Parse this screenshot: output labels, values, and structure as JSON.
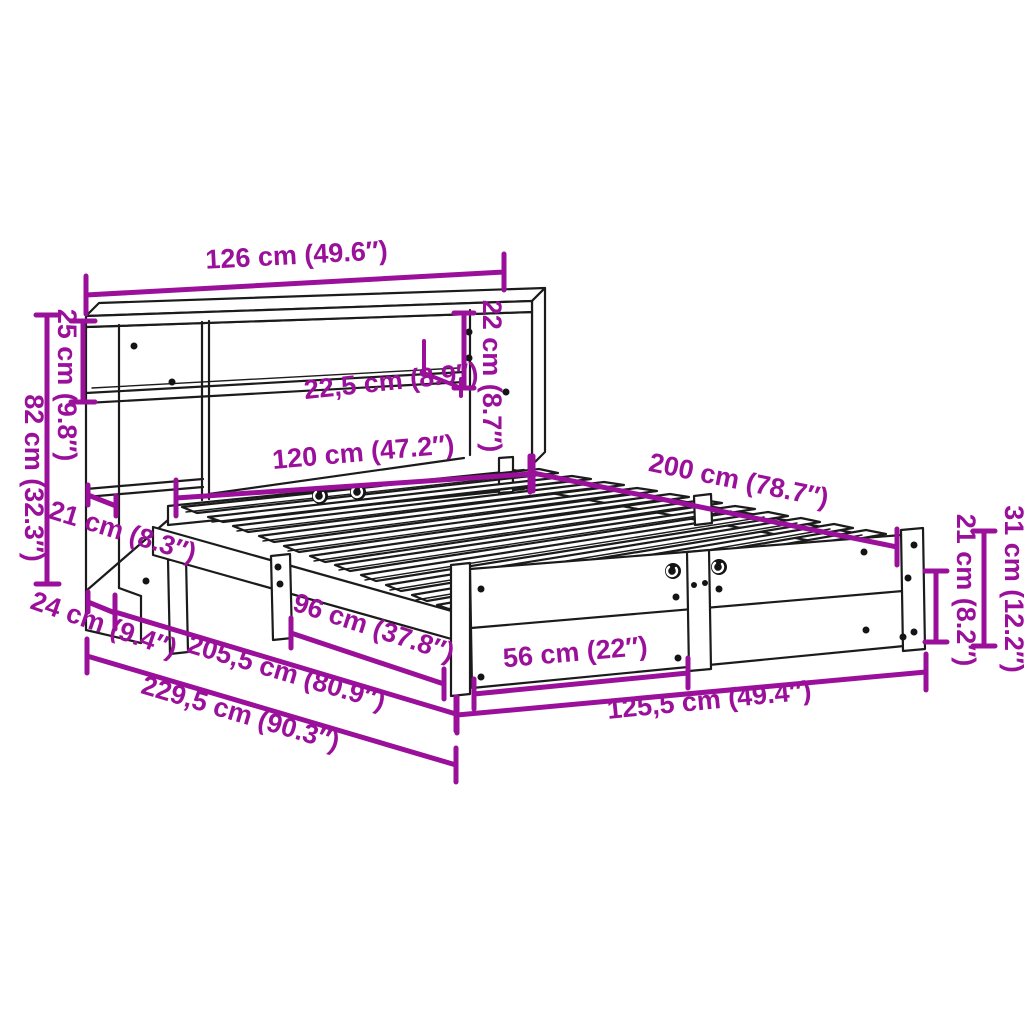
{
  "diagram": {
    "type": "product-dimension-diagram",
    "subject": "bookcase-bed-with-headboard-shelf",
    "background": "#ffffff",
    "accent_color": "#9a109a",
    "line_color": "#1b1b1b",
    "dimensions": [
      {
        "id": "headboard-width",
        "label": "126 cm (49.6″)"
      },
      {
        "id": "headboard-shelf-height",
        "label": "25 cm (9.8″)"
      },
      {
        "id": "headboard-height",
        "label": "82 cm (32.3″)"
      },
      {
        "id": "shelf-depth",
        "label": "22,5 cm (8.9″)"
      },
      {
        "id": "shelf-opening-height",
        "label": "22 cm (8.7″)"
      },
      {
        "id": "inner-width",
        "label": "120 cm (47.2″)"
      },
      {
        "id": "bed-length",
        "label": "200 cm (78.7″)"
      },
      {
        "id": "side-shelf-depth",
        "label": "21 cm (8.3″)"
      },
      {
        "id": "headboard-base-depth",
        "label": "24 cm (9.4″)"
      },
      {
        "id": "side-rail-span",
        "label": "96 cm (37.8″)"
      },
      {
        "id": "total-length",
        "label": "205,5 cm (80.9″)"
      },
      {
        "id": "overall-length",
        "label": "229,5 cm (90.3″)"
      },
      {
        "id": "footboard-section-width",
        "label": "56 cm (22″)"
      },
      {
        "id": "frame-width",
        "label": "125,5 cm (49.4″)"
      },
      {
        "id": "foot-rail-height",
        "label": "21 cm (8.2″)"
      },
      {
        "id": "foot-leg-height",
        "label": "31 cm (12.2″)"
      }
    ]
  }
}
